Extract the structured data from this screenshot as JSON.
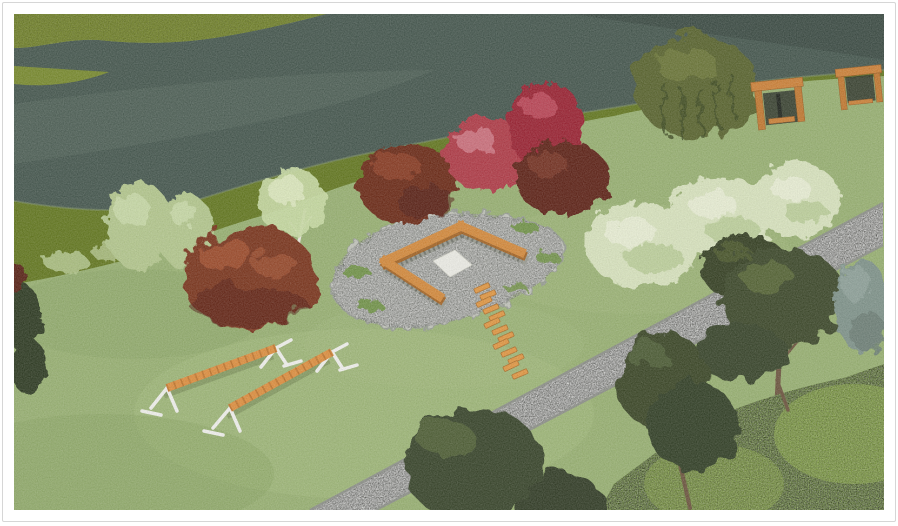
{
  "meta": {
    "type": "3d-landscape-render",
    "description": "3D visualization of a riverside park trim-trail design: gabion seating area with timber bench tops, timber stepping planks, two balance beams on white A-frames, two freestanding timber frames, a gravel footpath and mixed planting along a river"
  },
  "frame": {
    "page_bg": "#ffffff",
    "border_color": "#d6d6d6"
  },
  "palette": {
    "water": "#46584f",
    "water_light": "#5a6c61",
    "water_dark": "#34433d",
    "far_bank": "#7e9030",
    "bank_strip": "#64791f",
    "lawn": "#9ab373",
    "lawn_light": "#aec687",
    "gravel": "#cbccc4",
    "gravel_edge": "#8f928b",
    "patio_pad": "#c5c7bf",
    "timber": "#d88c3c",
    "timber_dark": "#a66524",
    "plank": "#e59a44",
    "gabion_stone": "#9b9d93",
    "sand": "#f0f0e9",
    "white_steel": "#f5f5f1",
    "beam_wood": "#e2913f",
    "frame_wood": "#d08338",
    "red_shrub": "#b23a47",
    "red_shrub_deep": "#9c2231",
    "maroon_shrub": "#5e2319",
    "rust_bush": "#7c341f",
    "dark_red_bush": "#6d2a19",
    "pale_tree": "#b6ca8f",
    "birch_foliage": "#ccdfa6",
    "birch_bark": "#eceadf",
    "flowering_shrub": "#dce7c1",
    "willow": "#5a652f",
    "dark_tree": "#38442a",
    "hedge": "#7ba13a",
    "spruce": "#81958c",
    "trunk": "#6e563f"
  },
  "scene": {
    "environment": [
      {
        "id": "river",
        "label": "river"
      },
      {
        "id": "far-bank",
        "label": "far river bank meadow"
      },
      {
        "id": "bank-strip",
        "label": "tall-grass river edge"
      },
      {
        "id": "lawn",
        "label": "park lawn"
      },
      {
        "id": "gravel-path",
        "label": "gravel footpath"
      }
    ],
    "features": [
      {
        "id": "seating-area",
        "label": "gabion seating area with timber bench tops on gravel pad"
      },
      {
        "id": "sand-square",
        "label": "central sand square"
      },
      {
        "id": "stepping-planks",
        "label": "timber stepping planks",
        "count": 13
      },
      {
        "id": "balance-beams",
        "label": "timber balance beams on white A-frame supports",
        "count": 2
      },
      {
        "id": "timber-frames",
        "label": "freestanding timber frames",
        "count": 2
      }
    ],
    "planting": [
      {
        "id": "pale-trees-left",
        "label": "pale green shrubs on bank"
      },
      {
        "id": "birch",
        "label": "silver birch"
      },
      {
        "id": "rust-bush",
        "label": "russet shrub"
      },
      {
        "id": "dark-red-bush",
        "label": "dark red shrub"
      },
      {
        "id": "crimson-shrubs",
        "label": "crimson ornamental shrubs"
      },
      {
        "id": "weeping-willow",
        "label": "weeping willow"
      },
      {
        "id": "flowering-shrubs",
        "label": "white flowering shrub row",
        "count": 3
      },
      {
        "id": "path-bush",
        "label": "dark green bush by path"
      },
      {
        "id": "pine",
        "label": "pine tree"
      },
      {
        "id": "spruce",
        "label": "blue-green spruce"
      },
      {
        "id": "hedge",
        "label": "clipped hedge block"
      },
      {
        "id": "bottom-trees",
        "label": "dark tree canopies over path"
      },
      {
        "id": "edge-tree-left",
        "label": "dark shrub at left edge"
      }
    ]
  }
}
